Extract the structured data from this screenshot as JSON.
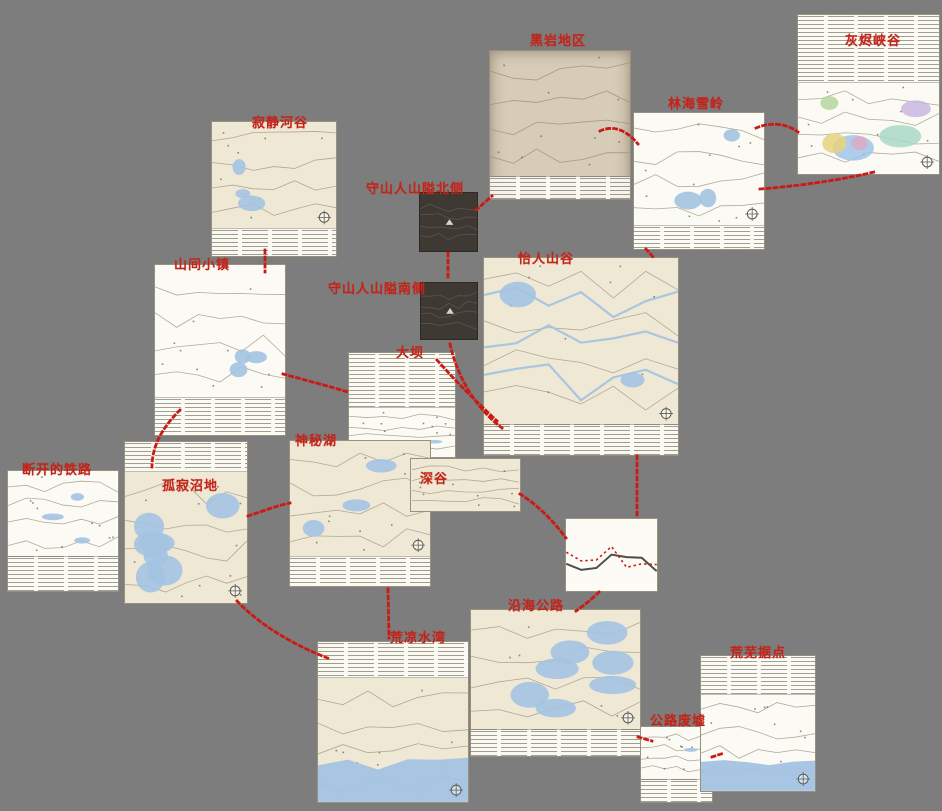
{
  "canvas": {
    "width": 942,
    "height": 811,
    "background": "#7d7d7d"
  },
  "colors": {
    "label": "#c3241a",
    "connector": "#cb1a14",
    "paper": "#efe8d4",
    "white_paper": "#fbfaf4",
    "parchment": "#d6ccb8",
    "photo": "#3e3933",
    "water": "#a3c3e2",
    "ink": "#a9a18c",
    "ink_dark": "#6f695e"
  },
  "regions": [
    {
      "id": "hushed-river-valley",
      "label": "寂静河谷",
      "x": 211,
      "y": 121,
      "w": 126,
      "h": 136,
      "kind": "paper",
      "legend": "bottom",
      "legend_size": 20,
      "water": "some",
      "compass": true,
      "label_x": 252,
      "label_y": 112
    },
    {
      "id": "blackrock",
      "label": "黑岩地区",
      "x": 489,
      "y": 50,
      "w": 142,
      "h": 150,
      "kind": "parchment",
      "legend": "bottom",
      "legend_size": 15,
      "water": "none",
      "compass": false,
      "label_x": 530,
      "label_y": 30
    },
    {
      "id": "timberwolf-mountain",
      "label": "林海雪岭",
      "x": 633,
      "y": 112,
      "w": 132,
      "h": 138,
      "kind": "white",
      "legend": "bottom",
      "legend_size": 17,
      "water": "some",
      "compass": true,
      "label_x": 668,
      "label_y": 93
    },
    {
      "id": "ash-canyon",
      "label": "灰烬峡谷",
      "x": 797,
      "y": 14,
      "w": 143,
      "h": 161,
      "kind": "colorful",
      "legend": "top",
      "legend_size": 42,
      "water": "none",
      "compass": true,
      "label_x": 845,
      "label_y": 30
    },
    {
      "id": "keepers-pass-north",
      "label": "守山人山隘北侧",
      "x": 419,
      "y": 192,
      "w": 59,
      "h": 60,
      "kind": "photo",
      "legend": "none",
      "legend_size": 0,
      "water": "none",
      "compass": false,
      "label_x": 366,
      "label_y": 178
    },
    {
      "id": "keepers-pass-south",
      "label": "守山人山隘南侧",
      "x": 420,
      "y": 282,
      "w": 58,
      "h": 58,
      "kind": "photo",
      "legend": "none",
      "legend_size": 0,
      "water": "none",
      "compass": false,
      "label_x": 328,
      "label_y": 278
    },
    {
      "id": "pleasant-valley",
      "label": "怡人山谷",
      "x": 483,
      "y": 257,
      "w": 196,
      "h": 199,
      "kind": "paper",
      "legend": "bottom",
      "legend_size": 15,
      "water": "rivers",
      "compass": true,
      "label_x": 518,
      "label_y": 248
    },
    {
      "id": "mountain-town",
      "label": "山间小镇",
      "x": 154,
      "y": 264,
      "w": 132,
      "h": 172,
      "kind": "white",
      "legend": "bottom",
      "legend_size": 22,
      "water": "some",
      "compass": false,
      "label_x": 174,
      "label_y": 254
    },
    {
      "id": "the-dam",
      "label": "大坝",
      "x": 348,
      "y": 352,
      "w": 108,
      "h": 106,
      "kind": "white",
      "legend": "top",
      "legend_size": 52,
      "water": "little",
      "compass": false,
      "label_x": 396,
      "label_y": 342
    },
    {
      "id": "mystery-lake",
      "label": "神秘湖",
      "x": 289,
      "y": 440,
      "w": 142,
      "h": 147,
      "kind": "paper",
      "legend": "bottom",
      "legend_size": 20,
      "water": "some",
      "compass": true,
      "label_x": 295,
      "label_y": 430
    },
    {
      "id": "the-ravine",
      "label": "深谷",
      "x": 410,
      "y": 458,
      "w": 111,
      "h": 54,
      "kind": "paper",
      "legend": "none",
      "legend_size": 0,
      "water": "none",
      "compass": false,
      "label_x": 420,
      "label_y": 468
    },
    {
      "id": "broken-railroad",
      "label": "断开的铁路",
      "x": 7,
      "y": 470,
      "w": 112,
      "h": 122,
      "kind": "white",
      "legend": "bottom",
      "legend_size": 28,
      "water": "some",
      "compass": false,
      "label_x": 22,
      "label_y": 459
    },
    {
      "id": "forlorn-muskeg",
      "label": "孤寂沼地",
      "x": 124,
      "y": 441,
      "w": 124,
      "h": 163,
      "kind": "paper",
      "legend": "top",
      "legend_size": 18,
      "water": "heavy",
      "compass": true,
      "label_x": 162,
      "label_y": 475
    },
    {
      "id": "far-range-branch-line",
      "label": "",
      "x": 565,
      "y": 518,
      "w": 93,
      "h": 74,
      "kind": "squiggle",
      "legend": "none",
      "legend_size": 0,
      "water": "none",
      "compass": false,
      "label_x": 0,
      "label_y": 0
    },
    {
      "id": "bleak-inlet",
      "label": "荒凉水湾",
      "x": 317,
      "y": 641,
      "w": 152,
      "h": 162,
      "kind": "paper",
      "legend": "top",
      "legend_size": 22,
      "water": "sea",
      "compass": true,
      "label_x": 390,
      "label_y": 627
    },
    {
      "id": "coastal-highway",
      "label": "沿海公路",
      "x": 470,
      "y": 609,
      "w": 171,
      "h": 148,
      "kind": "paper",
      "legend": "bottom",
      "legend_size": 18,
      "water": "heavy",
      "compass": true,
      "label_x": 508,
      "label_y": 595
    },
    {
      "id": "crumbling-highway",
      "label": "公路废墟",
      "x": 640,
      "y": 726,
      "w": 73,
      "h": 77,
      "kind": "white",
      "legend": "bottom",
      "legend_size": 30,
      "water": "little",
      "compass": false,
      "label_x": 650,
      "label_y": 710
    },
    {
      "id": "desolation-point",
      "label": "荒芜据点",
      "x": 700,
      "y": 655,
      "w": 116,
      "h": 137,
      "kind": "white",
      "legend": "top",
      "legend_size": 28,
      "water": "sea",
      "compass": true,
      "label_x": 730,
      "label_y": 642
    }
  ],
  "connectors": [
    {
      "d": "M265,250 L265,272"
    },
    {
      "d": "M476,210 L492,196"
    },
    {
      "d": "M600,131 C615,124 628,132 638,144"
    },
    {
      "d": "M756,128 C770,122 786,123 798,132"
    },
    {
      "d": "M760,189 C800,186 846,179 874,172"
    },
    {
      "d": "M448,253 L448,281"
    },
    {
      "d": "M450,344 C458,380 478,410 502,428"
    },
    {
      "d": "M437,360 C458,384 480,405 497,421"
    },
    {
      "d": "M180,410 C160,430 152,448 152,467"
    },
    {
      "d": "M283,374 C305,380 328,386 348,392"
    },
    {
      "d": "M248,516 C263,511 276,506 290,503"
    },
    {
      "d": "M237,601 C262,627 296,646 330,659"
    },
    {
      "d": "M388,589 L389,638"
    },
    {
      "d": "M520,494 C538,505 554,522 566,538"
    },
    {
      "d": "M637,456 L637,517"
    },
    {
      "d": "M599,592 C591,600 583,606 576,611"
    },
    {
      "d": "M638,737 L652,741"
    },
    {
      "d": "M712,757 L724,753"
    },
    {
      "d": "M646,249 L654,258"
    }
  ]
}
